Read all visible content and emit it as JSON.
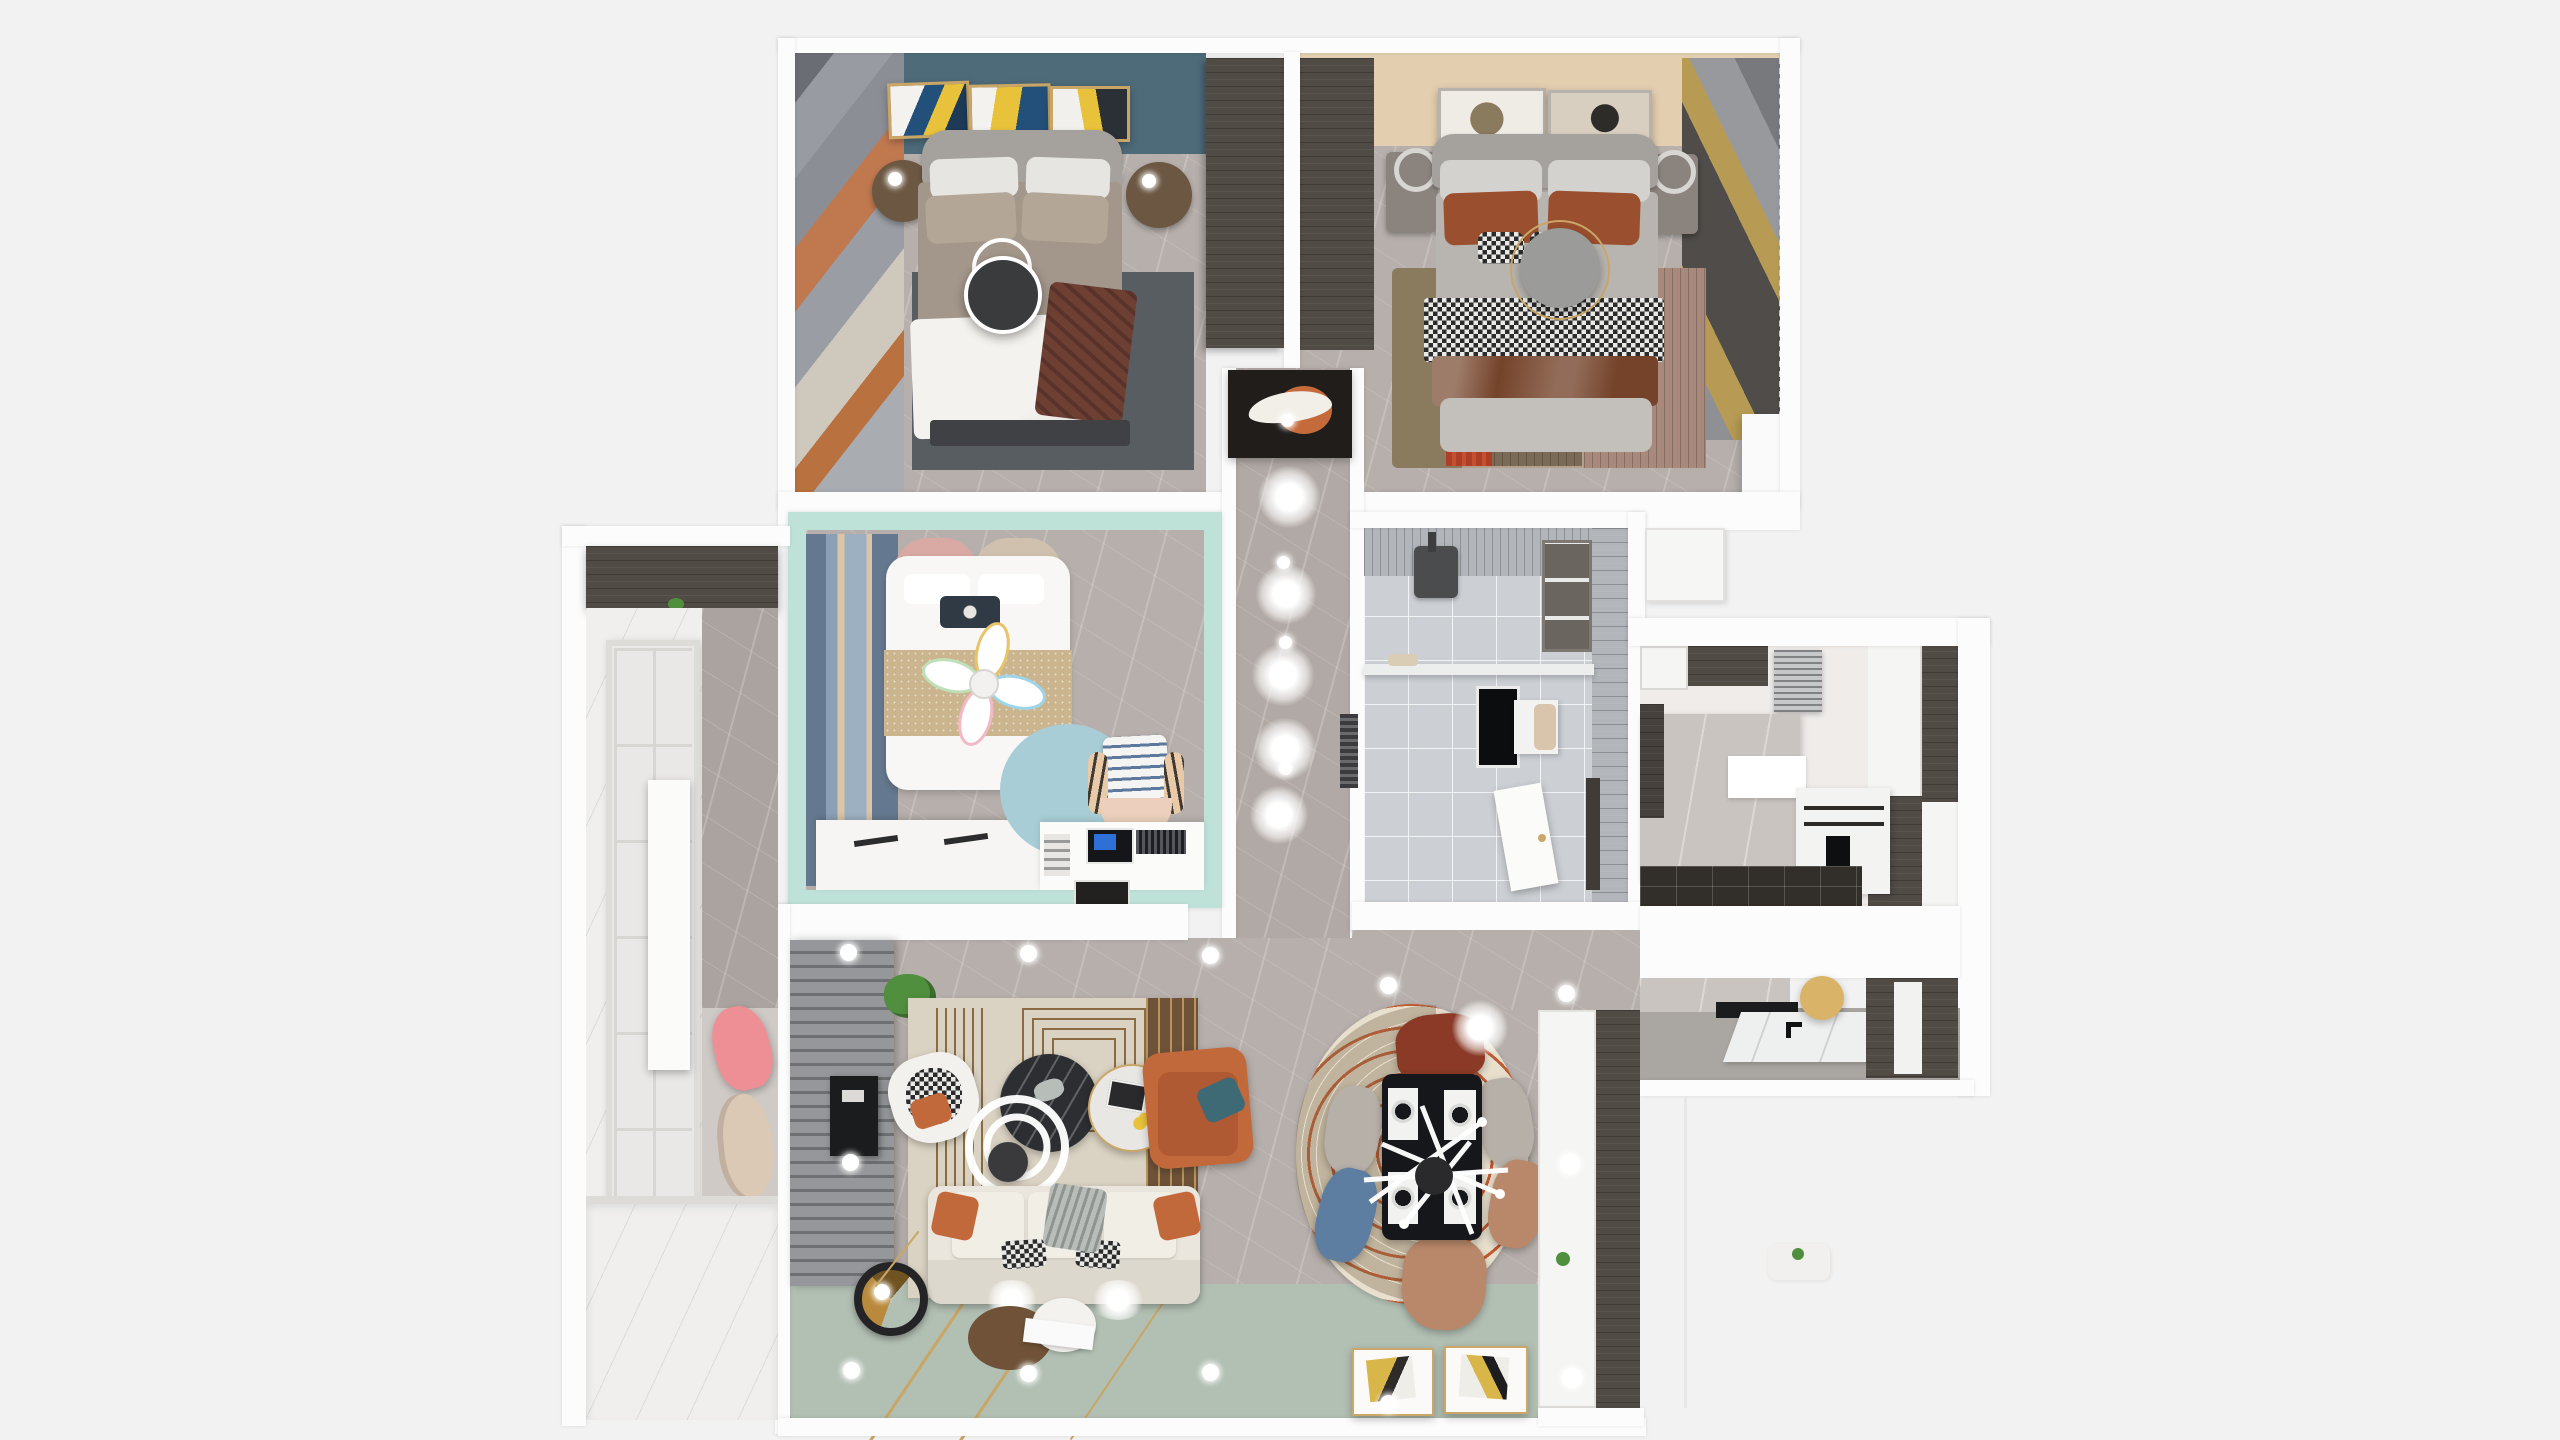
{
  "scene": {
    "kind": "3d-floor-plan-top-view-render",
    "rooms": [
      "master-bedroom",
      "second-bedroom",
      "kids-bedroom",
      "bathroom",
      "kitchen",
      "hallway",
      "living-room",
      "dining-area",
      "balcony",
      "entry"
    ]
  },
  "palette": {
    "canvas": "#f2f2f3",
    "wall": "#fcfcfc",
    "marble_floor": "#b6afab",
    "bath_floor": "#c6c9cd",
    "white_marble": "#f0efed",
    "sage_floor": "#b2bfb3",
    "gold": "#c9a566",
    "master_blue_wall": "#4e6b7a",
    "beige_wall": "#e3ceb0",
    "mint_wall": "#bfe2d8",
    "kids_rug_blue": "#a9cdd6",
    "bath_tile": "#ccd0d4",
    "bath_tile_dark": "#b2b6bb",
    "dark_wood": "#514b46",
    "espresso_floor": "#322e2a",
    "cabinet_white": "#f5f5f3",
    "accent_orange": "#c2693c",
    "teal_pillow": "#3e6a75",
    "taupe_duvet": "#a3968a",
    "rug_slate": "#585d62",
    "rug_cream": "#dad2c2",
    "rug_brown": "#6f5339",
    "rust_pillow": "#9a4f2e",
    "satin_brown": "#74432a",
    "pink_chair": "#ee8f96",
    "cream_chair": "#dcc9b5",
    "wood_ball": "#d9b368",
    "sofa_cream": "#eae6dd",
    "table_black": "#15171b",
    "chair_red": "#8a3a26",
    "chair_tan": "#b9886a",
    "chair_blue": "#5d7ea0",
    "chair_gray": "#b7b0a8",
    "dining_rug": "#e8dfcd",
    "dining_ring_orange": "#c05a32",
    "headboard_gray": "#a5a29e",
    "console_black": "#201d1b",
    "glow_white": "#ffffff",
    "plant_green": "#4f8f3d"
  }
}
